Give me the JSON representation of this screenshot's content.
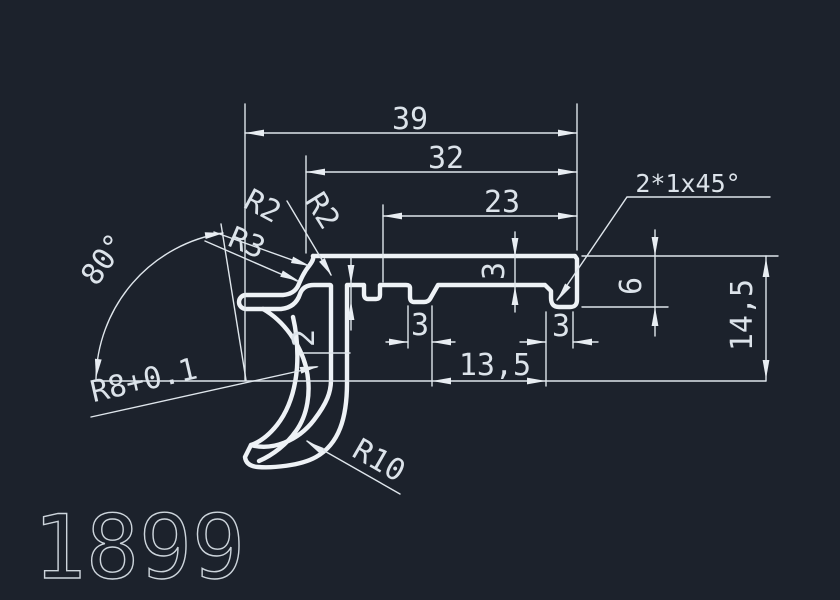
{
  "drawing": {
    "part_number": "1899",
    "colors": {
      "background": "#1c222c",
      "profile_line": "#eef2f6",
      "dimension_line": "#dfe6ec",
      "text": "#dce3ea"
    },
    "dims": {
      "total_width": "39",
      "width_32": "32",
      "width_23": "23",
      "chamfer_note": "2*1x45°",
      "plate_thickness": "3",
      "rib_width": "3",
      "hook_width": "3",
      "width_13_5": "13,5",
      "step_2": "2",
      "right_depth": "6",
      "total_height": "14,5",
      "angle": "80°",
      "radius_r2_a": "R2",
      "radius_r2_b": "R2",
      "radius_r3": "R3",
      "radius_r8": "R8+0.1",
      "radius_r10": "R10"
    }
  }
}
